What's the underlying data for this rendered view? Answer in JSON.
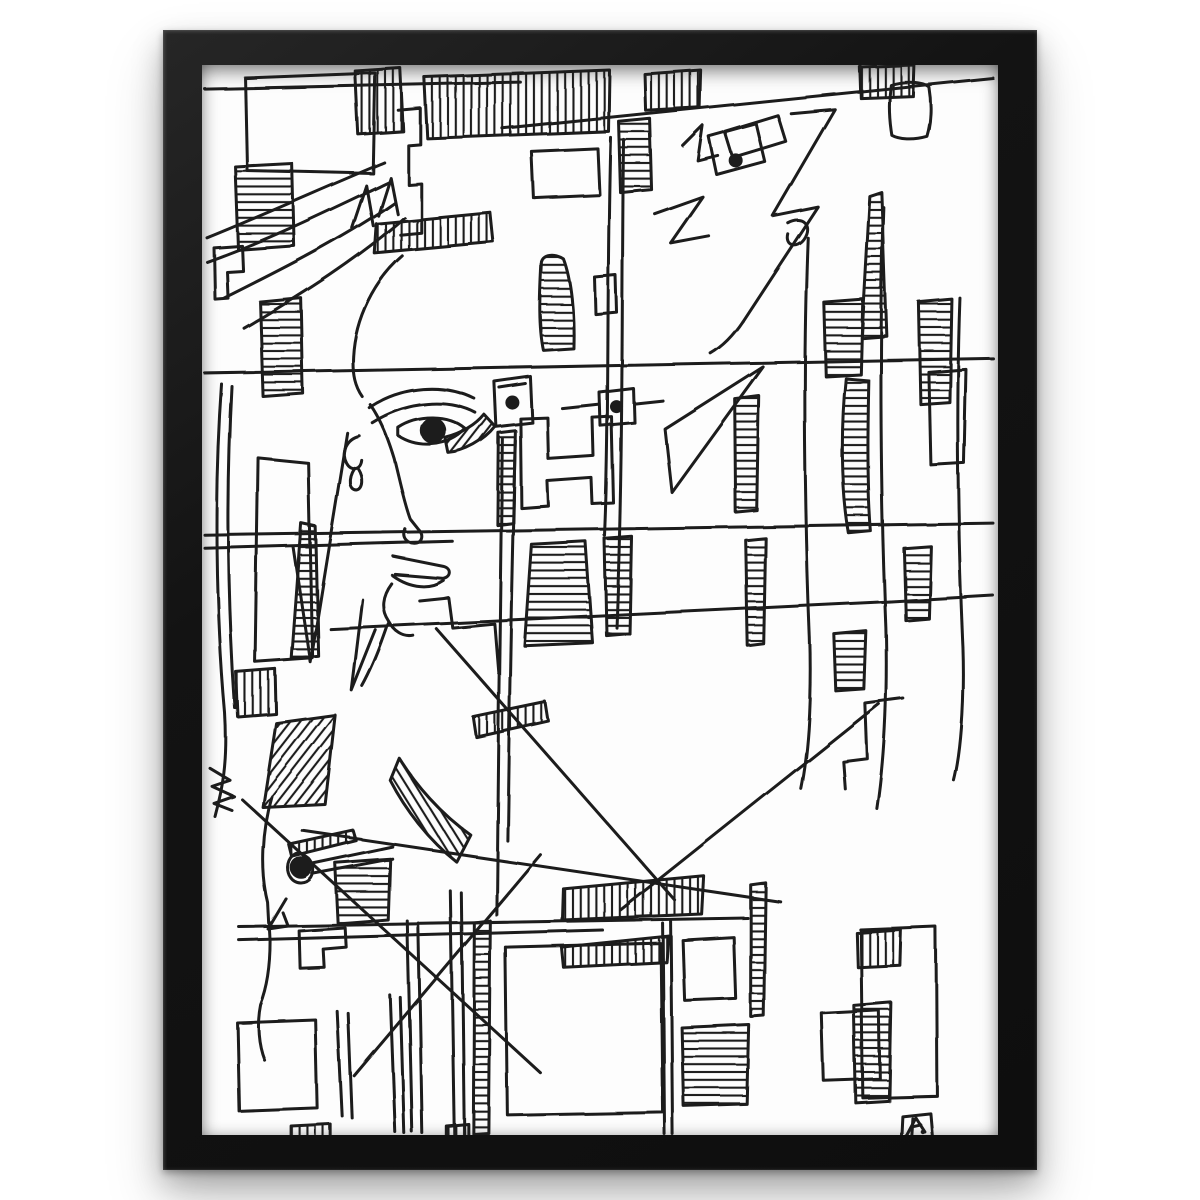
{
  "page": {
    "background_color": "#ffffff"
  },
  "frame": {
    "color": "#141414",
    "bevel_highlight_color": "#3c3c3c",
    "shadow_color": "rgba(0,0,0,0.3)",
    "orientation": "portrait"
  },
  "paper": {
    "color": "#fdfdfd"
  },
  "artwork": {
    "title": "Abstract single-line ink drawing of overlapping faces with hatched rectangles",
    "medium": "black ink on white paper",
    "ink_color": "#1b1b1b",
    "motifs": [
      "large profile face with filled eye",
      "two small boxed eyes",
      "angular face upper right",
      "small profile face lower left",
      "horizontally and vertically hatched rectangles",
      "long crossing diagonal lines"
    ],
    "signature": {
      "type": "boxed monogram with dot",
      "position": "bottom-right"
    }
  }
}
